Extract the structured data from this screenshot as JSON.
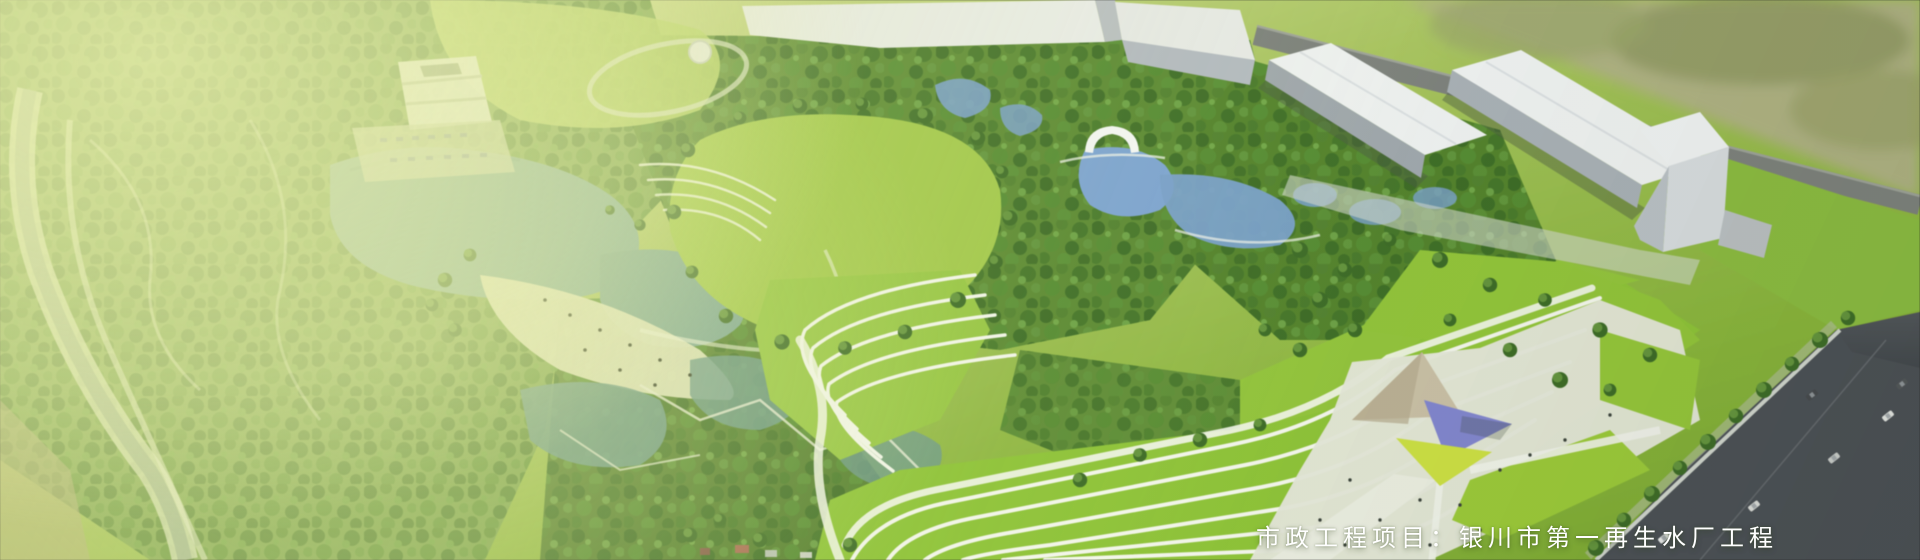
{
  "caption": {
    "text": "市政工程项目：银川市第一再生水厂工程"
  },
  "palette": {
    "lawn": "#a3c84f",
    "lawn_bright": "#8fc23c",
    "forest": "#4f7c30",
    "lake": "#86ad9b",
    "wetland": "#6f9a8c",
    "pond_blue": "#7ea4d0",
    "building_white": "#edf0ef",
    "plaza": "#e3e6d8",
    "beach": "#dfe3c2",
    "path_white": "#f3f6ec",
    "road_dark": "#4c5156",
    "canopy_purple": "#8286cb",
    "canopy_yellow": "#cbdf48",
    "canopy_tan": "#c8bfa6",
    "caption_color": "#ffffff"
  }
}
